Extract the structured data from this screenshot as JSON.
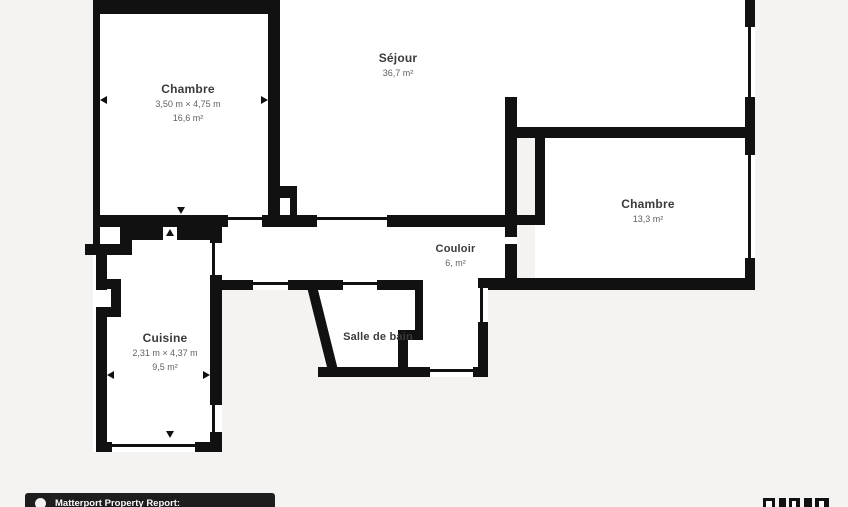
{
  "plan": {
    "type": "floor-plan",
    "colors": {
      "background": "#f4f3f1",
      "room_fill": "#ffffff",
      "wall": "#111111",
      "title_text": "#3b3b3b",
      "subtext": "#616161",
      "footer_bg": "#1d1d1d",
      "footer_text": "#fafafa"
    },
    "rooms": [
      {
        "id": "chambre-left",
        "name": "Chambre",
        "dimensions": "3,50 m × 4,75 m",
        "area": "16,6 m²"
      },
      {
        "id": "sejour",
        "name": "Séjour",
        "area": "36,7 m²"
      },
      {
        "id": "chambre-right",
        "name": "Chambre",
        "area": "13,3 m²"
      },
      {
        "id": "couloir",
        "name": "Couloir",
        "area": "6, m²"
      },
      {
        "id": "cuisine",
        "name": "Cuisine",
        "dimensions": "2,31 m × 4,37 m",
        "area": "9,5 m²"
      },
      {
        "id": "salle-de-bain",
        "name": "Salle de bain"
      }
    ],
    "footer": {
      "brand": "Matterport Property Report:",
      "logo_icon": "matterport-logo"
    }
  }
}
